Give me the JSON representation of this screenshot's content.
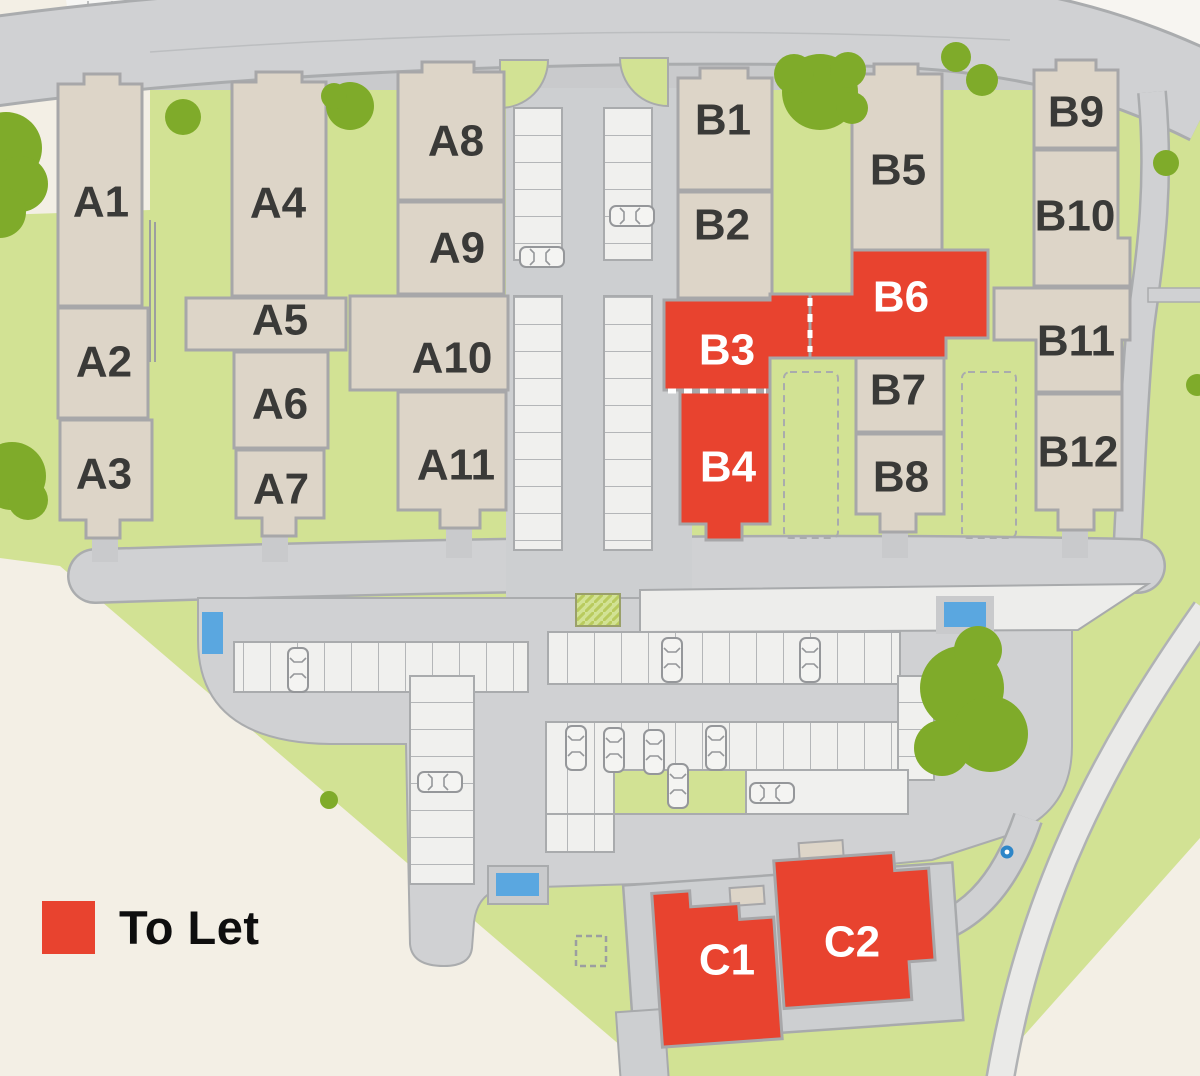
{
  "legend": {
    "label": "To Let",
    "swatch_color": "#e8432f"
  },
  "colors": {
    "background": "#f3efe5",
    "green": "#d2e294",
    "tree": "#7fab2a",
    "road": "#d0d1d3",
    "road_dark": "#c9cacc",
    "road_edge": "#a8aaac",
    "bay_fill": "#f0f0ee",
    "unit_fill": "#ddd5c8",
    "unit_stroke": "#a7a7a9",
    "unit_label": "#3a3a38",
    "to_let_fill": "#e8432f",
    "to_let_label": "#ffffff",
    "water": "#5aa7e0",
    "water_dot": "#2e86c8"
  },
  "units": {
    "A1": {
      "label": "A1",
      "status": "standard"
    },
    "A2": {
      "label": "A2",
      "status": "standard"
    },
    "A3": {
      "label": "A3",
      "status": "standard"
    },
    "A4": {
      "label": "A4",
      "status": "standard"
    },
    "A5": {
      "label": "A5",
      "status": "standard"
    },
    "A6": {
      "label": "A6",
      "status": "standard"
    },
    "A7": {
      "label": "A7",
      "status": "standard"
    },
    "A8": {
      "label": "A8",
      "status": "standard"
    },
    "A9": {
      "label": "A9",
      "status": "standard"
    },
    "A10": {
      "label": "A10",
      "status": "standard"
    },
    "A11": {
      "label": "A11",
      "status": "standard"
    },
    "B1": {
      "label": "B1",
      "status": "standard"
    },
    "B2": {
      "label": "B2",
      "status": "standard"
    },
    "B3": {
      "label": "B3",
      "status": "to_let"
    },
    "B4": {
      "label": "B4",
      "status": "to_let"
    },
    "B5": {
      "label": "B5",
      "status": "standard"
    },
    "B6": {
      "label": "B6",
      "status": "to_let"
    },
    "B7": {
      "label": "B7",
      "status": "standard"
    },
    "B8": {
      "label": "B8",
      "status": "standard"
    },
    "B9": {
      "label": "B9",
      "status": "standard"
    },
    "B10": {
      "label": "B10",
      "status": "standard"
    },
    "B11": {
      "label": "B11",
      "status": "standard"
    },
    "B12": {
      "label": "B12",
      "status": "standard"
    },
    "C1": {
      "label": "C1",
      "status": "to_let"
    },
    "C2": {
      "label": "C2",
      "status": "to_let"
    }
  }
}
